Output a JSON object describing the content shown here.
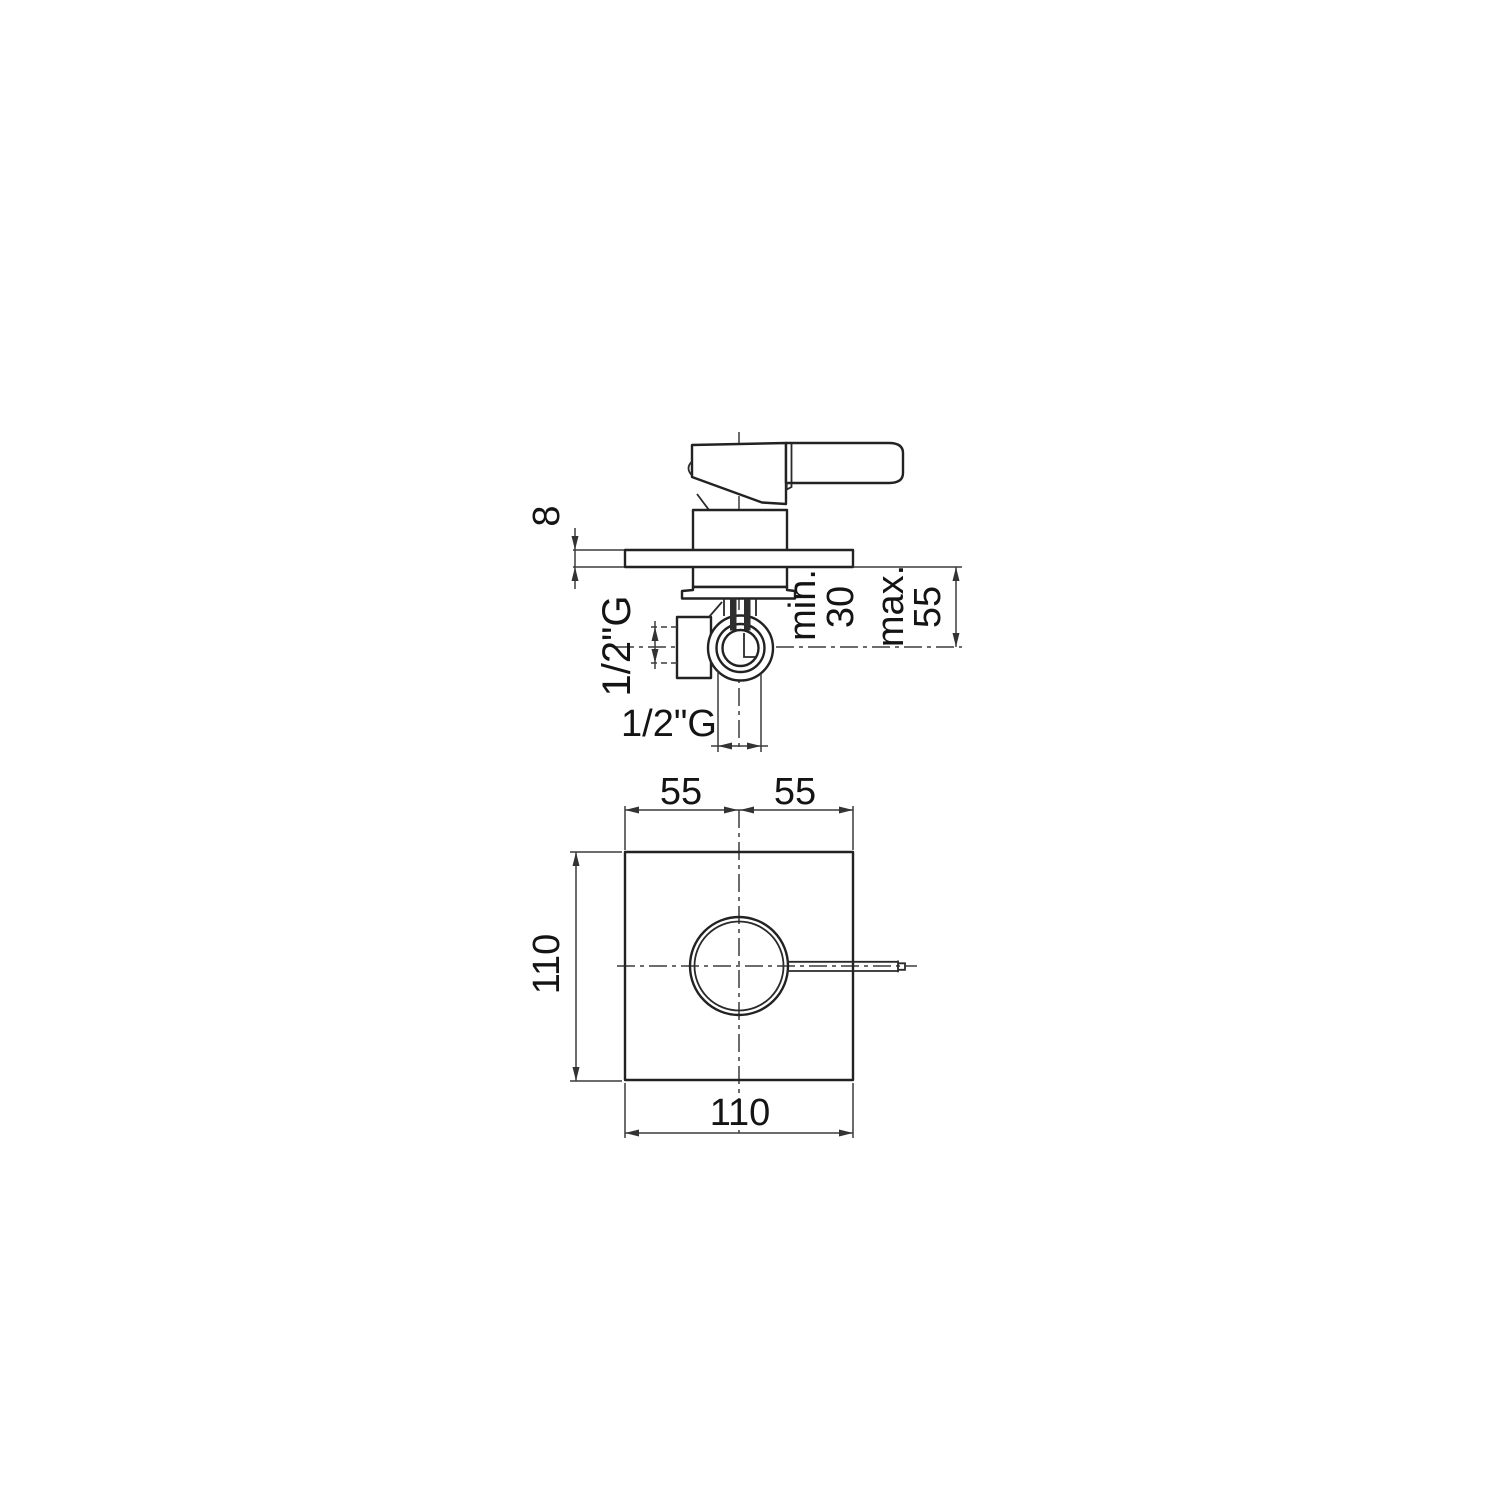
{
  "side_view": {
    "plate_thickness": "8",
    "min_label": "min.",
    "min_value": "30",
    "max_label": "max.",
    "max_value": "55",
    "side_port": "1/2\"G",
    "bottom_port": "1/2\"G"
  },
  "front_view": {
    "half_width_left": "55",
    "half_width_right": "55",
    "height": "110",
    "width": "110"
  }
}
